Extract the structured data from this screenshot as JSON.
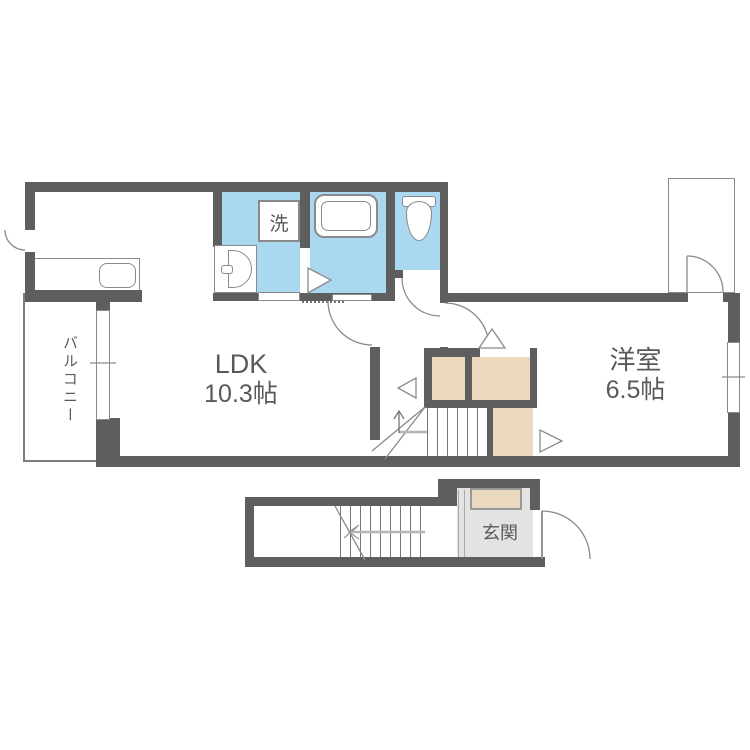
{
  "rooms": {
    "ldk": {
      "label": "LDK",
      "size": "10.3帖"
    },
    "western_room": {
      "label": "洋室",
      "size": "6.5帖"
    },
    "balcony": {
      "label": "バルコニー"
    },
    "entrance": {
      "label": "玄関"
    },
    "laundry": {
      "label": "洗"
    }
  },
  "colors": {
    "background": "#ffffff",
    "wall": "#5e5e5e",
    "wet_area_floor": "#a9d8f0",
    "storage_fill": "#ead9bf",
    "entrance_floor": "#e3e3e3",
    "fixture_line": "#8a8a8a",
    "label_text": "#595959"
  }
}
